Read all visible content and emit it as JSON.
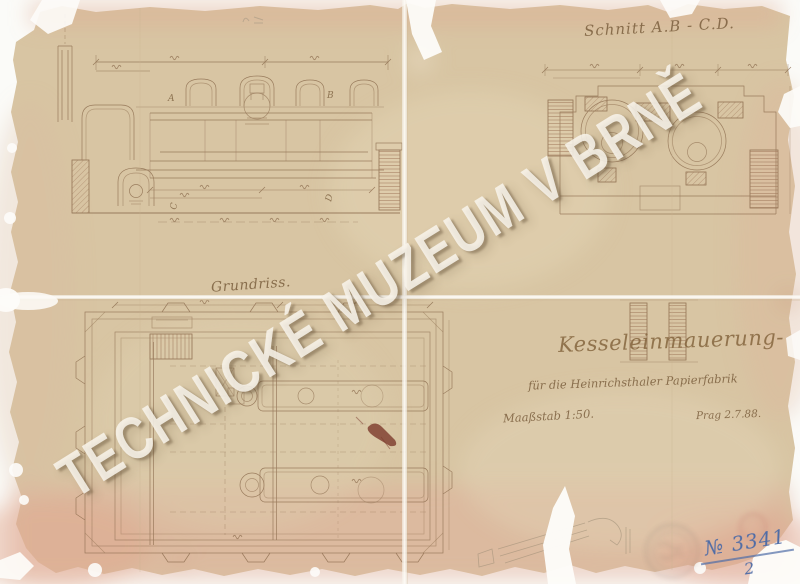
{
  "document": {
    "watermark": "TECHNICKÉ MUZEUM V BRNĚ",
    "section_label": "Schnitt A.B - C.D.",
    "plan_label": "Grundriss.",
    "title": "Kesseleinmauerung-",
    "subtitle": "für die Heinrichsthaler Papierfabrik",
    "scale_label": "Maaßstab 1:50.",
    "place_date": "Prag 2.7.88.",
    "inventory": {
      "number": "№ 3341",
      "sheet": "2"
    },
    "cut_letters": {
      "a": "A",
      "b": "B",
      "c": "C",
      "d": "D"
    },
    "colors": {
      "paper": "#d8c5a3",
      "ink": "#8a6a4c",
      "stamp_blue": "#4f6ca6",
      "blot_red": "#7c3a2c"
    }
  }
}
